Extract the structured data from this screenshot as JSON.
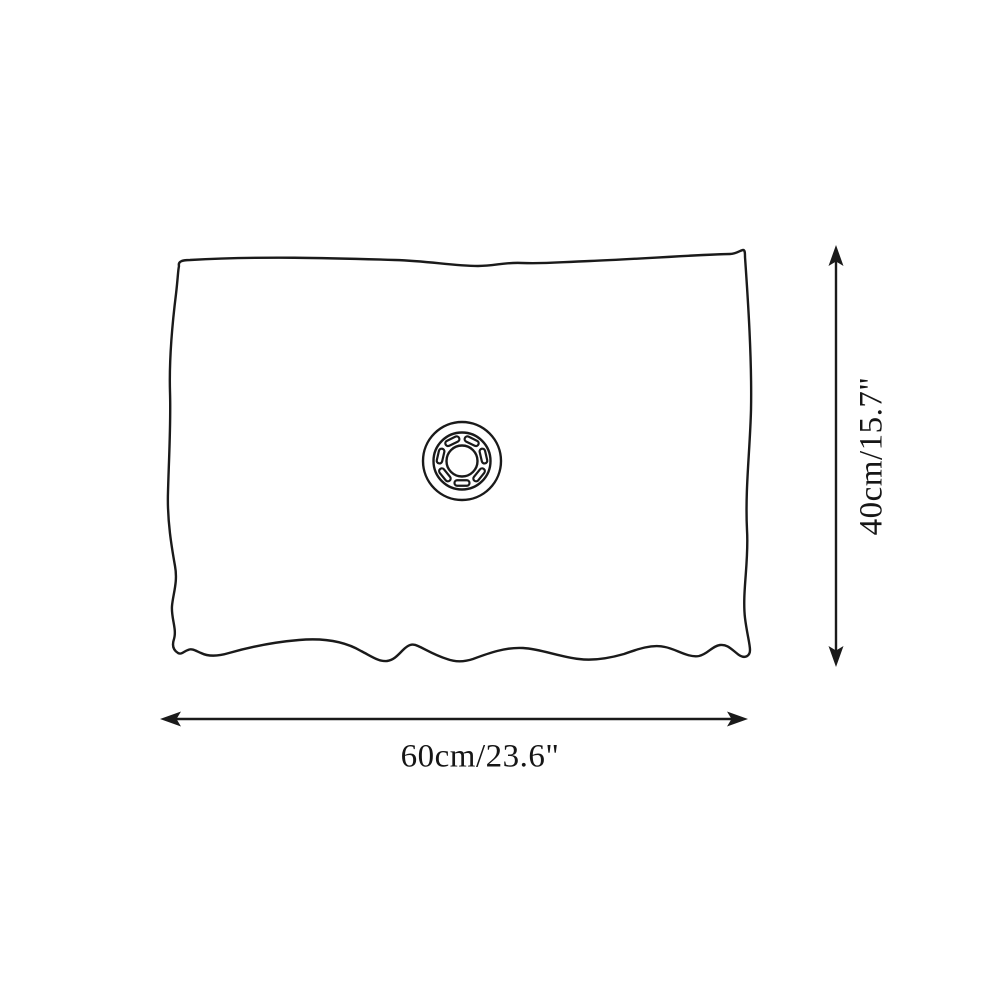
{
  "diagram": {
    "type": "product-dimension-diagram",
    "width_label": "60cm/23.6\"",
    "height_label": "40cm/15.7\"",
    "line_color": "#1a1a1a",
    "text_color": "#161616",
    "background_color": "#ffffff",
    "icons": {
      "center_valve": "circular-valve-with-radial-slots",
      "width_arrow": "double-headed-horizontal-arrow",
      "height_arrow": "double-headed-vertical-arrow"
    }
  }
}
